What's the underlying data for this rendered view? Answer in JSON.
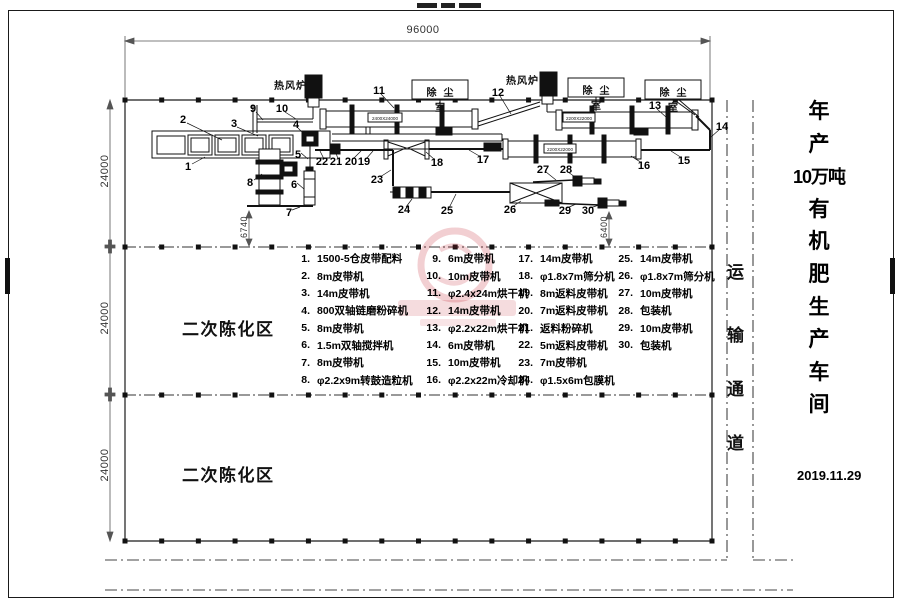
{
  "sheet_title": {
    "vertical_chars": [
      "年",
      "产",
      "10万吨",
      "有",
      "机",
      "肥",
      "生",
      "产",
      "车",
      "间"
    ],
    "date": "2019.11.29"
  },
  "corridor_chars": [
    "运",
    "输",
    "通",
    "道"
  ],
  "zones": {
    "zone_upper": "二次陈化区",
    "zone_lower": "二次陈化区"
  },
  "dimensions": {
    "top_width": "96000",
    "bays": [
      "24000",
      "24000",
      "24000"
    ],
    "granulator_drop": "6740",
    "packer_drop": "6400"
  },
  "equipment_labels": {
    "furnace1": "热风炉",
    "furnace2": "热风炉",
    "dust_rooms": [
      "除尘室",
      "除尘室",
      "除尘室"
    ],
    "drum11_size": "2400X24000",
    "drum13_size": "2200X22000",
    "drum16_size": "2200X22000"
  },
  "callouts": [
    "1",
    "2",
    "3",
    "4",
    "5",
    "6",
    "7",
    "8",
    "9",
    "10",
    "11",
    "12",
    "13",
    "14",
    "15",
    "16",
    "17",
    "18",
    "19",
    "20",
    "21",
    "22",
    "23",
    "24",
    "25",
    "26",
    "27",
    "28",
    "29",
    "30"
  ],
  "legend": {
    "items": [
      {
        "no": "1.",
        "name": "1500-5仓皮带配料"
      },
      {
        "no": "2.",
        "name": "8m皮带机"
      },
      {
        "no": "3.",
        "name": "14m皮带机"
      },
      {
        "no": "4.",
        "name": "800双轴链磨粉碎机"
      },
      {
        "no": "5.",
        "name": "8m皮带机"
      },
      {
        "no": "6.",
        "name": "1.5m双轴搅拌机"
      },
      {
        "no": "7.",
        "name": "8m皮带机"
      },
      {
        "no": "8.",
        "name": "φ2.2x9m转鼓造粒机"
      },
      {
        "no": "9.",
        "name": "6m皮带机"
      },
      {
        "no": "10.",
        "name": "10m皮带机"
      },
      {
        "no": "11.",
        "name": "φ2.4x24m烘干机"
      },
      {
        "no": "12.",
        "name": "14m皮带机"
      },
      {
        "no": "13.",
        "name": "φ2.2x22m烘干机"
      },
      {
        "no": "14.",
        "name": "6m皮带机"
      },
      {
        "no": "15.",
        "name": "10m皮带机"
      },
      {
        "no": "16.",
        "name": "φ2.2x22m冷却机"
      },
      {
        "no": "17.",
        "name": "14m皮带机"
      },
      {
        "no": "18.",
        "name": "φ1.8x7m筛分机"
      },
      {
        "no": "19.",
        "name": "8m返料皮带机"
      },
      {
        "no": "20.",
        "name": "7m返料皮带机"
      },
      {
        "no": "21.",
        "name": "返料粉碎机"
      },
      {
        "no": "22.",
        "name": "5m返料皮带机"
      },
      {
        "no": "23.",
        "name": "7m皮带机"
      },
      {
        "no": "24.",
        "name": "φ1.5x6m包膜机"
      },
      {
        "no": "25.",
        "name": "14m皮带机"
      },
      {
        "no": "26.",
        "name": "φ1.8x7m筛分机"
      },
      {
        "no": "27.",
        "name": "10m皮带机"
      },
      {
        "no": "28.",
        "name": "包装机"
      },
      {
        "no": "29.",
        "name": "10m皮带机"
      },
      {
        "no": "30.",
        "name": "包装机"
      }
    ]
  }
}
